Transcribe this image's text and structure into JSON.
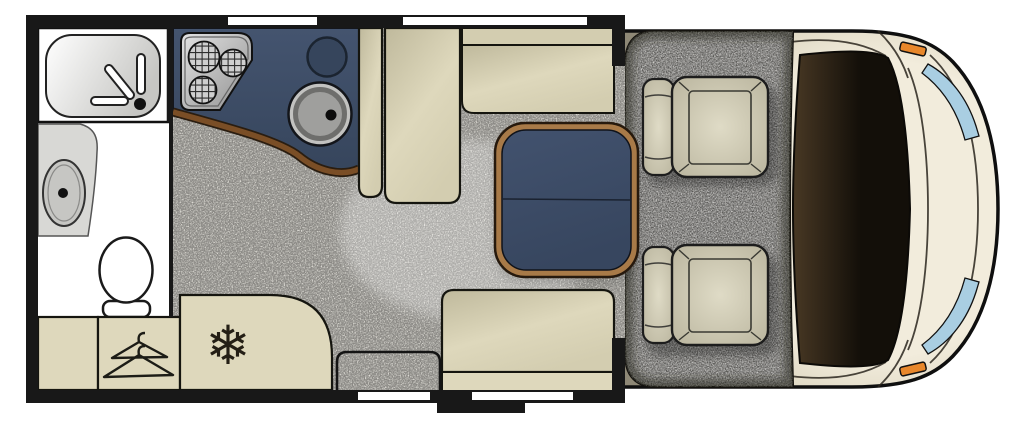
{
  "page": {
    "background": "#ffffff"
  },
  "palette": {
    "wall": "#181818",
    "white": "#ffffff",
    "floor": "#e7e5de",
    "vanity": "#d8d8d5",
    "basin": "#c6c6c3",
    "counter_top": "#44546f",
    "counter_bottom": "#36455c",
    "trim_brown": "#7a4e26",
    "table_trim": "#a87a48",
    "table_top": "#42526e",
    "table_bottom": "#37465f",
    "bench_light": "#ded8bc",
    "bench_mid": "#d3cdb0",
    "bench_dark": "#bfb99c",
    "seat_light": "#dfdbc6",
    "seat_dark": "#b7b29b",
    "carpet": "#b3b1ac",
    "cab_body_light": "#f2ecdc",
    "cab_body_mid": "#ddd6c1",
    "cab_body_dark": "#8e8876",
    "windshield_inner": "#483824",
    "windshield_outer": "#130f09",
    "glass": "#a9cee2",
    "indicator_orange": "#e8872b",
    "steel_light": "#e3e3e3",
    "steel_dark": "#909090"
  },
  "icons": {
    "freezer_glyph": "❄",
    "wardrobe_icon": "clothes-hangers",
    "hob_icon": "three-burner-hob",
    "sink_icon": "round-sink",
    "shower_icon": "shower-tray",
    "basin_icon": "wash-basin",
    "toilet_icon": "toilet"
  },
  "plan": {
    "type": "motorhome-floorplan",
    "zones": [
      "washroom",
      "kitchen",
      "wardrobe",
      "fridge-freezer",
      "dinette-lounge",
      "entry-door",
      "cab"
    ],
    "seats": [
      "side-bench",
      "forward-sofa",
      "rear-bench",
      "passenger-seat",
      "driver-seat"
    ],
    "table": "pedestal-table",
    "windows": 3,
    "doors": 1,
    "steps": 1
  }
}
